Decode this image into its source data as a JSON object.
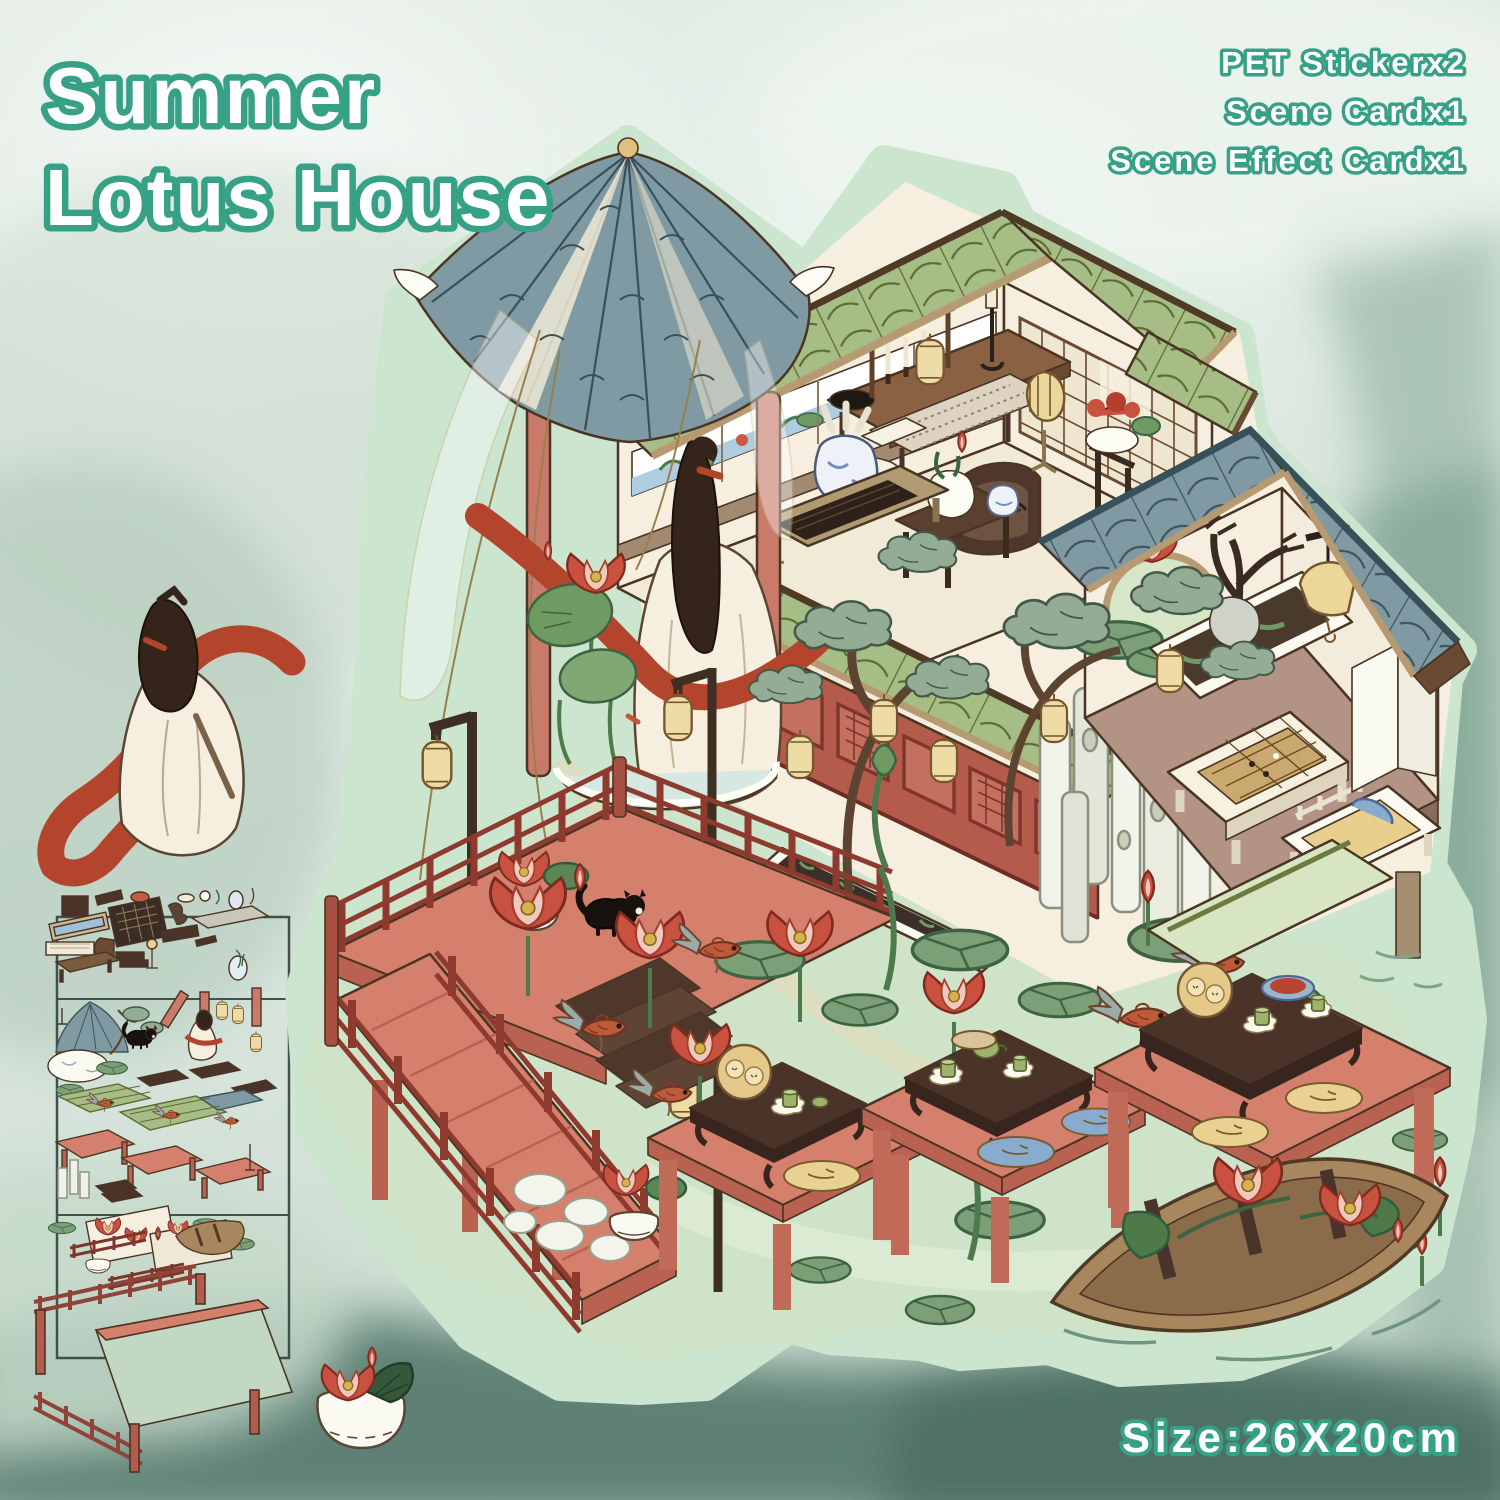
{
  "title": {
    "line1": "Summer",
    "line2": "Lotus House"
  },
  "contents": {
    "items": [
      "PET Stickerx2",
      "Scene Cardx1",
      "Scene Effect Cardx1"
    ]
  },
  "size": {
    "label": "Size:26X20cm"
  },
  "colors": {
    "title_green": "#36a184",
    "ink": "#4a3423",
    "sticker_border": "#cbe5cf",
    "roof_green": "#a6bd85",
    "roof_green_line": "#5c6a33",
    "roof_blue": "#7f9aa3",
    "roof_blue_line": "#3e545c",
    "wall_cream": "#f6efdf",
    "wall_tan": "#a18a6f",
    "corridor_red": "#b45b4b",
    "lattice_dark": "#7e352c",
    "pillar_red": "#c97a69",
    "salmon": "#d5806c",
    "dark_wood": "#4a3328",
    "mid_wood": "#7a5b3e",
    "pond": "#cfe3c8",
    "pond_light": "#dfeccf",
    "pad_green": "#7d9f78",
    "leaf_dark": "#3c6342",
    "lotus_red": "#c8523f",
    "lotus_light": "#f0c9bc",
    "koi": "#bd5a3a",
    "fin_gray": "#9aaca6",
    "lantern": "#eedca6",
    "lantern_line": "#77552f",
    "robe": "#f6eede",
    "ribbon": "#b2452c",
    "hair": "#34241a",
    "boat": "#a8875f",
    "stone_white": "#f0f1e8",
    "cushion_yellow": "#e9d291",
    "cushion_blue": "#89abcd",
    "porcelain_blue": "#6f8fc0",
    "mountain_mid": "#8fae9d",
    "mountain_dark": "#587c6e",
    "frame_line": "#41504a"
  }
}
